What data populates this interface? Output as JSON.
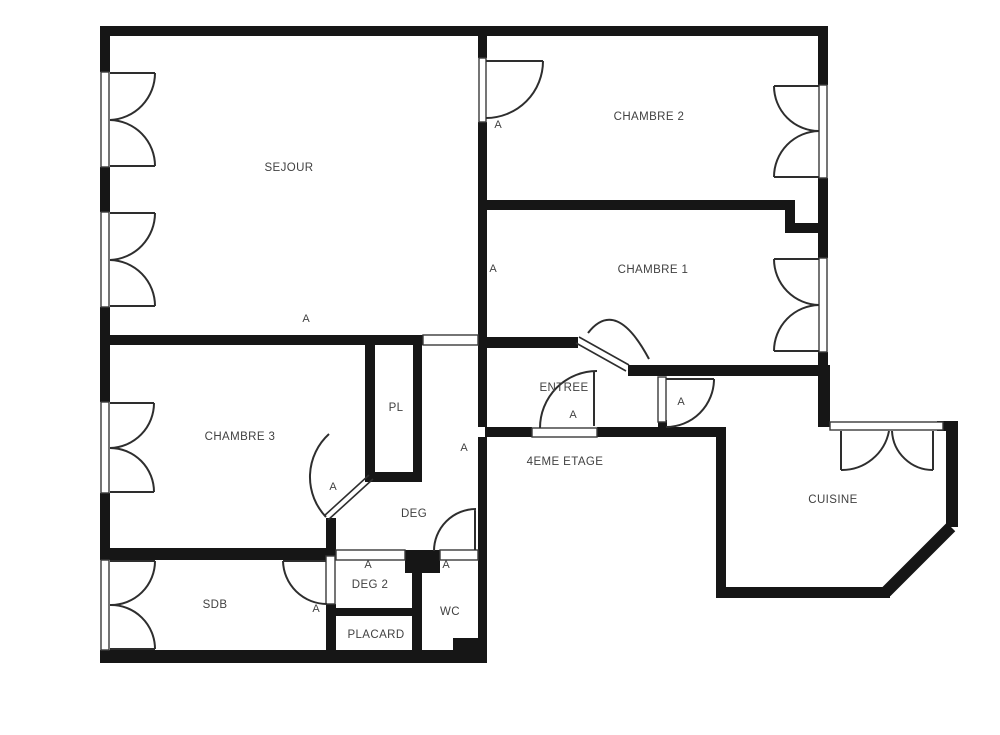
{
  "plan": {
    "type": "apartment-floor-plan",
    "floor_label": "4EME ETAGE",
    "rooms": {
      "sejour": "SEJOUR",
      "chambre2": "CHAMBRE 2",
      "chambre1": "CHAMBRE 1",
      "chambre3": "CHAMBRE 3",
      "pl": "PL",
      "entree": "ENTREE",
      "deg": "DEG",
      "cuisine": "CUISINE",
      "deg2": "DEG 2",
      "wc": "WC",
      "placard": "PLACARD",
      "sdb": "SDB"
    },
    "annotations": [
      "A",
      "A",
      "A",
      "A",
      "A",
      "A",
      "A",
      "A",
      "A",
      "A"
    ],
    "colors": {
      "background": "#ffffff",
      "wall": "#161616",
      "line": "#2e2e2e",
      "text": "#414141"
    }
  }
}
